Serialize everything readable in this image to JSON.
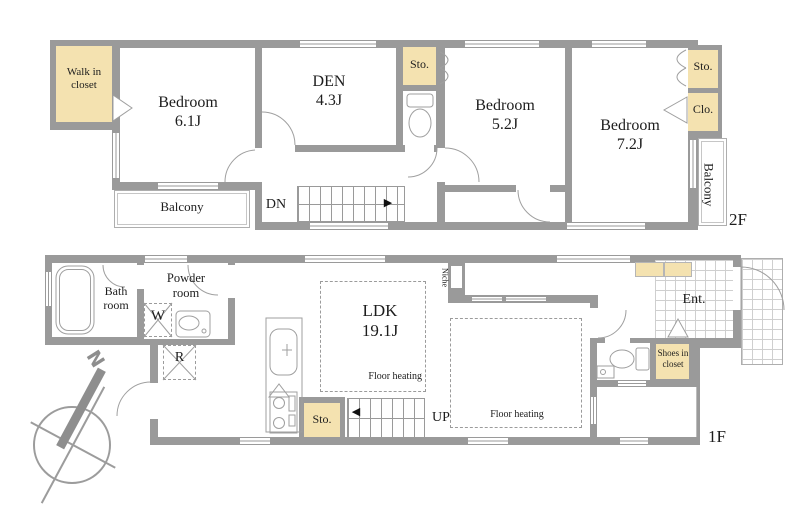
{
  "colors": {
    "wall": "#9a9a9a",
    "closet_fill": "#f4e2b0",
    "thin_line": "#aeaeae",
    "text": "#1d1d1d"
  },
  "floor_2f": {
    "floor_label": "2F",
    "walk_in_closet": "Walk in\ncloset",
    "bedroom_61": "Bedroom\n6.1J",
    "den": "DEN\n4.3J",
    "storage_mid": "Sto.",
    "bedroom_52": "Bedroom\n5.2J",
    "bedroom_72": "Bedroom\n7.2J",
    "storage_right": "Sto.",
    "closet": "Clo.",
    "balcony_left": "Balcony",
    "balcony_right": "Balcony",
    "stairs_down": "DN"
  },
  "floor_1f": {
    "floor_label": "1F",
    "bath_room": "Bath\nroom",
    "powder_room": "Powder\nroom",
    "washer": "W",
    "refrigerator": "R",
    "ldk": "LDK\n19.1J",
    "floor_heating_left": "Floor heating",
    "floor_heating_right": "Floor heating",
    "niche": "Niche",
    "storage": "Sto.",
    "stairs_up": "UP",
    "entrance": "Ent.",
    "shoes_closet": "Shoes in\ncloset"
  },
  "compass": {
    "north": "N"
  },
  "icons": {
    "stairs_down_arrow": "▶",
    "stairs_up_arrow": "◀"
  }
}
